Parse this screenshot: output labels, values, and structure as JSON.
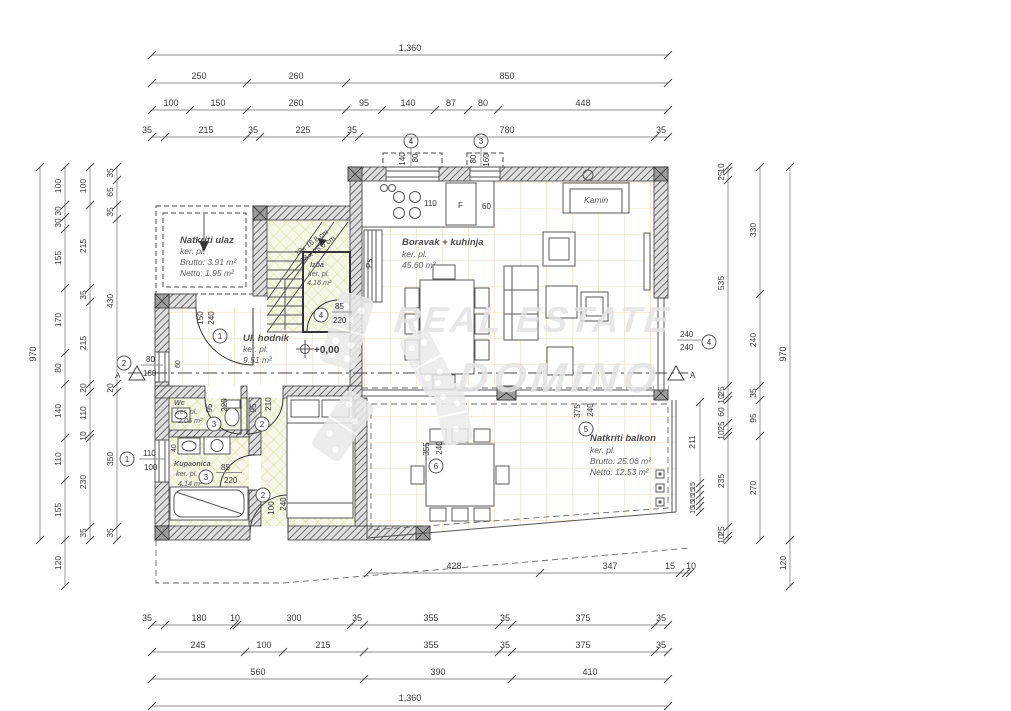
{
  "watermark": {
    "line1": "REAL ESTATE",
    "line2": "DOMINO"
  },
  "rooms": {
    "porch": {
      "name": "Natkriti ulaz",
      "floor": "ker. pl.",
      "brutto": "Brutto: 3.91 m²",
      "netto": "Netto: 1.95 m²"
    },
    "hall": {
      "name": "Ul. hodnik",
      "floor": "ker. pl.",
      "area": "9.51 m²"
    },
    "pantry": {
      "name": "Izba",
      "floor": "ker. pl.",
      "area": "4.16 m²"
    },
    "living": {
      "name": "Boravak + kuhinja",
      "floor": "ker. pl.",
      "area": "45.60 m²"
    },
    "wc": {
      "name": "Wc",
      "floor": "ker. pl.",
      "area": "2.06 m²"
    },
    "bath": {
      "name": "Kupaonica",
      "floor": "ker. pl.",
      "area": "4.14 m²"
    },
    "balcony": {
      "name": "Natkriti balkon",
      "floor": "ker. pl.",
      "brutto": "Brutto: 25.06 m²",
      "netto": "Netto: 12.53 m²"
    }
  },
  "labels": {
    "fireplace": "Kamin",
    "level": "+0,00",
    "pantry_shelf": "Ps",
    "fridge": "F",
    "stove": "110",
    "counter": "60",
    "stairs_line1": "19x 16.8 cm",
    "stairs_line2": "18 x 25.0 cm",
    "section": "A",
    "sink": "40",
    "wall": "60"
  },
  "openings": {
    "door1": {
      "no": "1",
      "w": "150",
      "h": "240"
    },
    "door2_bedroom": {
      "no": "2",
      "w": "95",
      "h": "210"
    },
    "door2_terrace": {
      "no": "2",
      "w": "100",
      "h": "240"
    },
    "door3_wc": {
      "no": "3",
      "w": "95",
      "h": "220"
    },
    "door3_bath": {
      "no": "3",
      "w": "85",
      "h": "220"
    },
    "door4_pantry": {
      "no": "4",
      "w": "85",
      "h": "220"
    },
    "win1": {
      "no": "1",
      "w": "110",
      "h": "100"
    },
    "win2": {
      "no": "2",
      "w": "80",
      "h": "180"
    },
    "win3": {
      "no": "3",
      "w": "80",
      "h": "160"
    },
    "win4_top": {
      "no": "4",
      "w": "140",
      "h": "80"
    },
    "win4_right": {
      "no": "4",
      "w": "240",
      "h": "240"
    },
    "win5": {
      "no": "5",
      "w": "375",
      "h": "240"
    },
    "win6": {
      "no": "6",
      "w": "355",
      "h": "240"
    }
  },
  "dims": {
    "top": {
      "total": "1,360",
      "row2": [
        "250",
        "260",
        "850"
      ],
      "row3": [
        "100",
        "150",
        "260",
        "95",
        "140",
        "87",
        "80",
        "448"
      ],
      "row4": [
        "35",
        "215",
        "35",
        "225",
        "35",
        "780",
        "35"
      ]
    },
    "bottom": {
      "terrace": [
        "428",
        "347",
        "15",
        "10"
      ],
      "row1": [
        "35",
        "180",
        "10",
        "300",
        "35",
        "355",
        "35",
        "375",
        "35"
      ],
      "row2": [
        "245",
        "100",
        "215",
        "355",
        "35",
        "375",
        "35"
      ],
      "row3": [
        "560",
        "390",
        "410"
      ],
      "total": "1,360"
    },
    "left": {
      "total": "970",
      "col2": [
        "100",
        "30",
        "30",
        "155",
        "170",
        "80",
        "140",
        "110",
        "155",
        "120"
      ],
      "col3": [
        "100",
        "215",
        "35",
        "215",
        "20",
        "110",
        "10",
        "230",
        "35"
      ],
      "col4": [
        "35",
        "65",
        "35",
        "430",
        "20",
        "350",
        "35"
      ]
    },
    "right": {
      "total": "970",
      "below": "120",
      "col1": [
        "10",
        "25",
        "535",
        "25",
        "10",
        "60",
        "25",
        "10",
        "235",
        "25",
        "10"
      ],
      "col2": [
        "330",
        "240",
        "35",
        "95",
        "270"
      ],
      "balcony": [
        "211",
        "15",
        "15",
        "15",
        "15",
        "15"
      ]
    }
  }
}
